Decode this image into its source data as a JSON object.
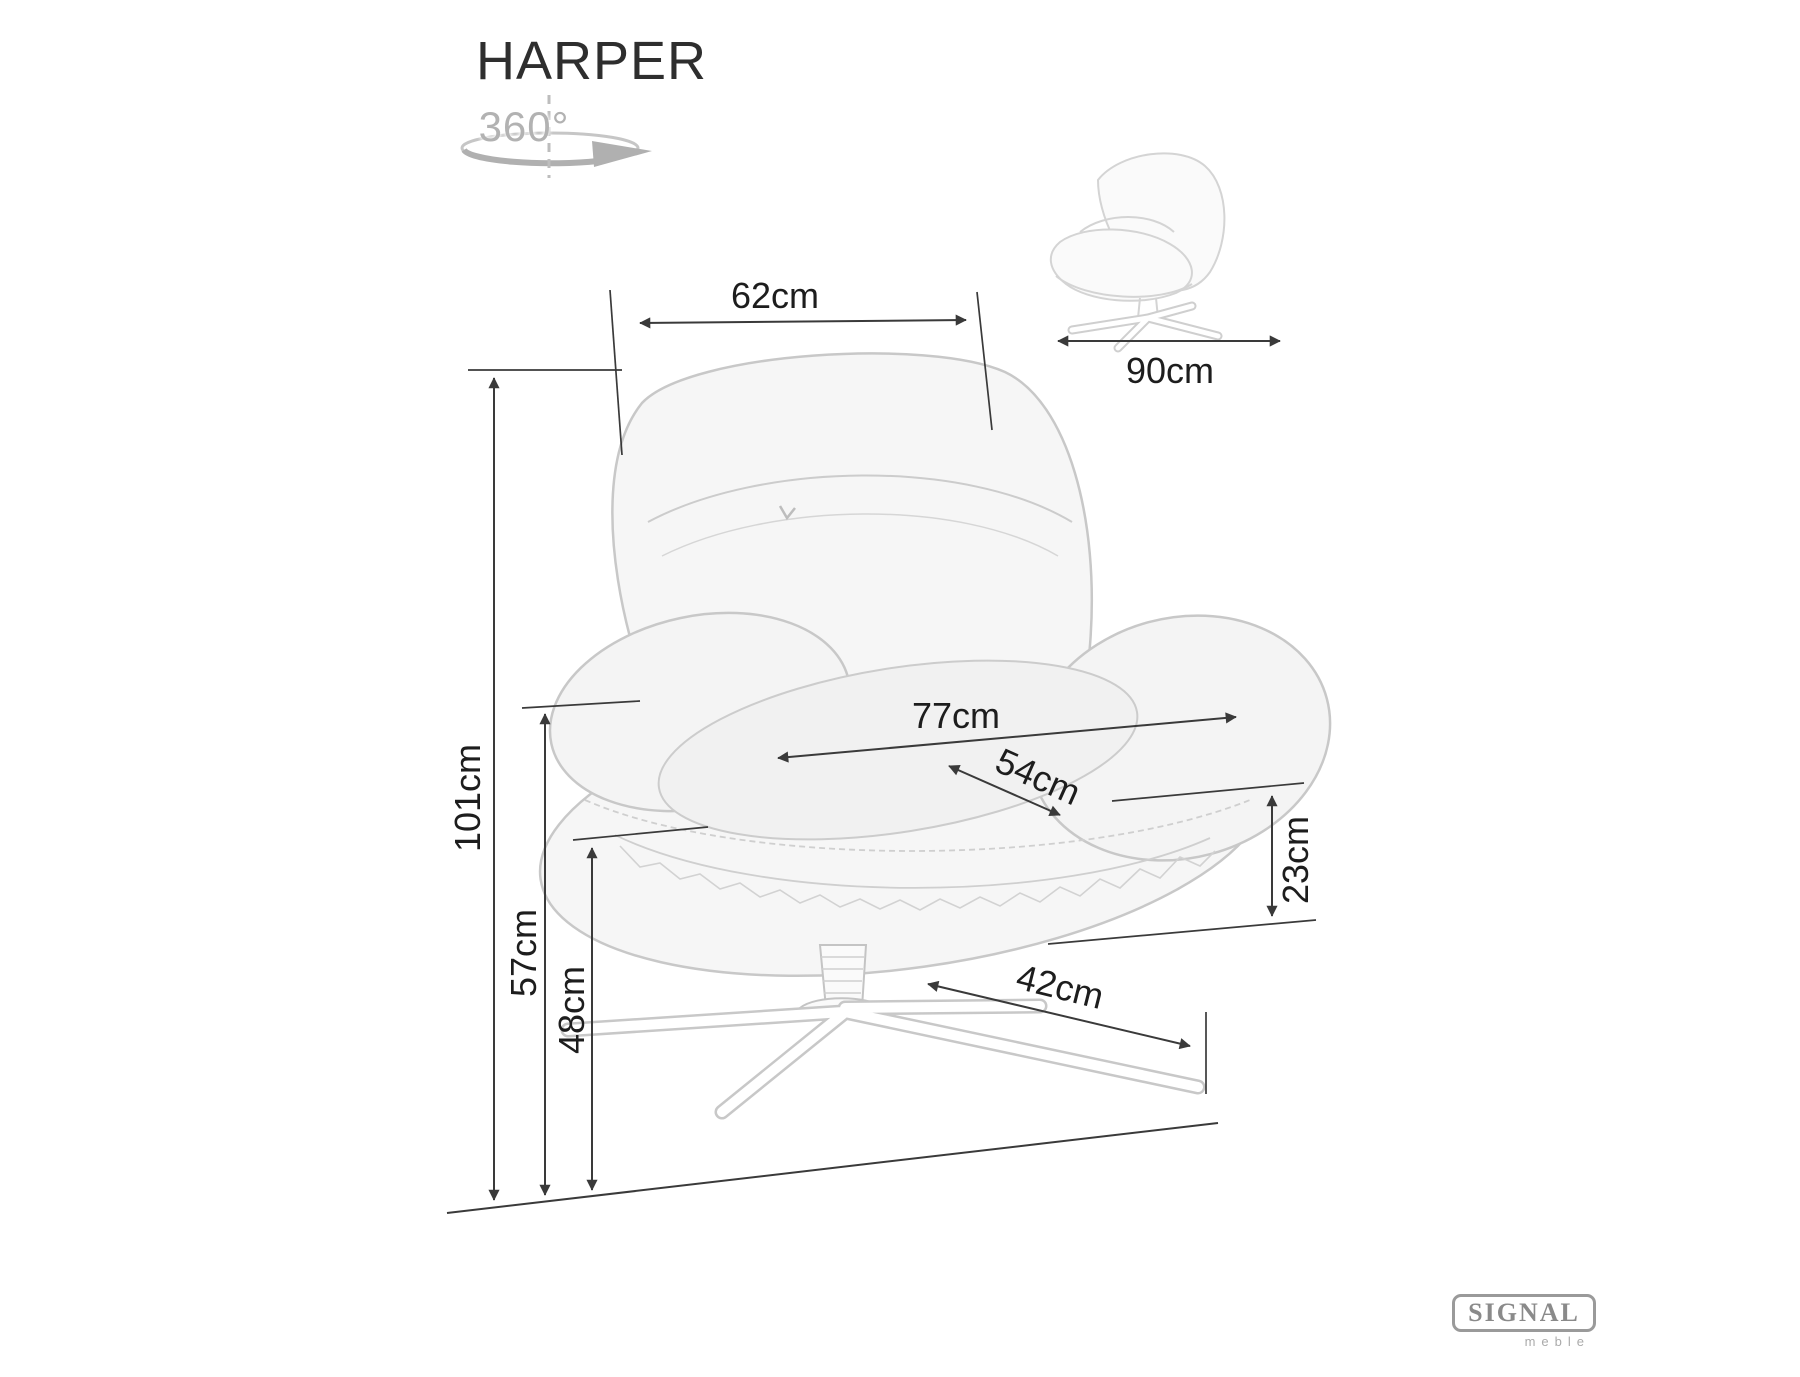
{
  "header": {
    "title": "HARPER",
    "rotation_label": "360°"
  },
  "dimensions": {
    "backrest_width": {
      "label": "62cm"
    },
    "side_depth": {
      "label": "90cm"
    },
    "total_height": {
      "label": "101cm"
    },
    "armrest_height": {
      "label": "57cm"
    },
    "seat_height": {
      "label": "48cm"
    },
    "outer_seat_width": {
      "label": "77cm"
    },
    "inner_seat_width": {
      "label": "54cm"
    },
    "cushion_height": {
      "label": "23cm"
    },
    "base_leg_length": {
      "label": "42cm"
    }
  },
  "logo": {
    "brand": "SIGNAL",
    "sub": "meble"
  },
  "icons": {
    "rotation": "360-rotation-icon"
  },
  "colors": {
    "dimension_line": "#3a3a3a",
    "label_text": "#1d1d1d",
    "sketch_stroke": "#c8c8c8",
    "sketch_fill": "#f6f6f6",
    "muted_gray": "#b2b2b2",
    "logo_gray": "#8a8a8a"
  }
}
